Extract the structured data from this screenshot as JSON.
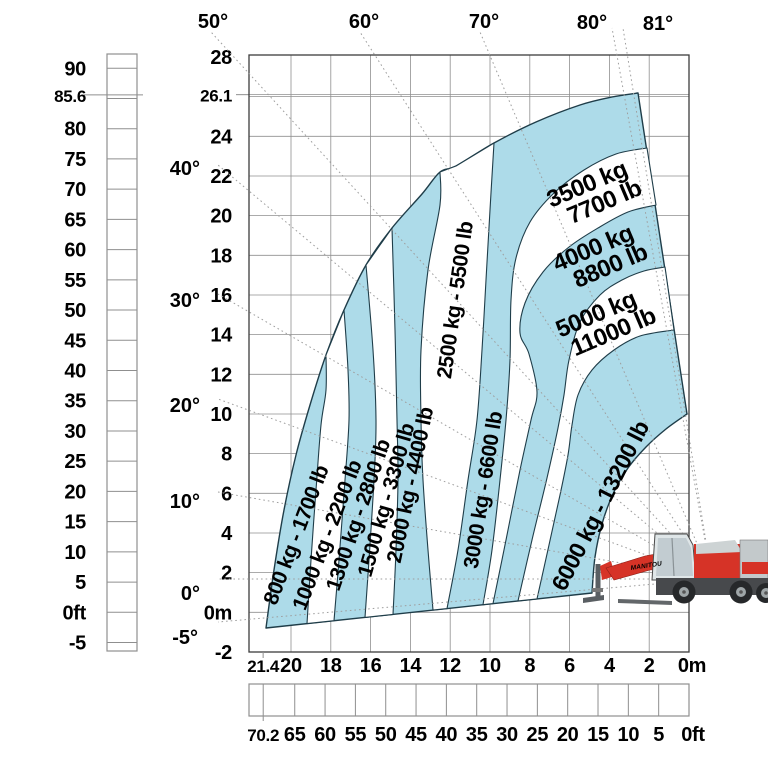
{
  "brand": "MANITOU",
  "colors": {
    "zone_blue": "#addbe9",
    "zone_white": "#ffffff",
    "outline": "#1f3d49",
    "grid": "#8f8f8f",
    "border": "#3c3c3c",
    "dotted_line": "#9e9e9e",
    "text": "#000000",
    "machine_red": "#d63327",
    "machine_dark": "#47494c",
    "machine_light": "#dfe6e8"
  },
  "chart_data": {
    "type": "area",
    "title": "",
    "description": "Telehandler load capacity envelope chart: lift height (m/ft) versus reach (m/ft) with boom angle lines and load capacity zones",
    "grid": true,
    "legend_position": "none",
    "x_axis": {
      "meters_ticks": [
        "21.4",
        "20",
        "18",
        "16",
        "14",
        "12",
        "10",
        "8",
        "6",
        "4",
        "2",
        "0m"
      ],
      "feet_ticks": [
        "70.2",
        "65",
        "60",
        "55",
        "50",
        "45",
        "40",
        "35",
        "30",
        "25",
        "20",
        "15",
        "10",
        "5",
        "0ft"
      ],
      "max_reach_m": 21.4,
      "max_reach_ft": 70.2,
      "range_m": [
        0,
        22.1
      ]
    },
    "y_axis": {
      "meters_ticks": [
        "28",
        "26.1",
        "24",
        "22",
        "20",
        "18",
        "16",
        "14",
        "12",
        "10",
        "8",
        "6",
        "4",
        "2",
        "0m",
        "-2"
      ],
      "feet_ticks": [
        "90",
        "85.6",
        "80",
        "75",
        "70",
        "65",
        "60",
        "55",
        "50",
        "45",
        "40",
        "35",
        "30",
        "25",
        "20",
        "15",
        "10",
        "5",
        "0ft",
        "-5"
      ],
      "max_height_m": 26.1,
      "max_height_ft": 85.6,
      "range_m": [
        -2,
        28.1
      ]
    },
    "boom_angles_top": [
      "50°",
      "60°",
      "70°",
      "80°",
      "81°"
    ],
    "boom_angles_left": [
      "40°",
      "30°",
      "20°",
      "10°",
      "0°",
      "-5°"
    ],
    "zones": [
      {
        "kg": 800,
        "lb": 1700,
        "label_lines": [
          "800 kg - 1700 lb"
        ],
        "fill": "blue"
      },
      {
        "kg": 1000,
        "lb": 2200,
        "label_lines": [
          "1000 kg - 2200 lb"
        ],
        "fill": "white"
      },
      {
        "kg": 1300,
        "lb": 2800,
        "label_lines": [
          "1300 kg - 2800 lb"
        ],
        "fill": "blue"
      },
      {
        "kg": 1500,
        "lb": 3300,
        "label_lines": [
          "1500 kg - 3300 lb"
        ],
        "fill": "white"
      },
      {
        "kg": 2000,
        "lb": 4400,
        "label_lines": [
          "2000 kg - 4400 lb"
        ],
        "fill": "blue"
      },
      {
        "kg": 2500,
        "lb": 5500,
        "label_lines": [
          "2500 kg - 5500 lb"
        ],
        "fill": "white"
      },
      {
        "kg": 3000,
        "lb": 6600,
        "label_lines": [
          "3000 kg - 6600 lb"
        ],
        "fill": "blue"
      },
      {
        "kg": 3500,
        "lb": 7700,
        "label_lines": [
          "3500 kg",
          "7700 lb"
        ],
        "fill": "white"
      },
      {
        "kg": 4000,
        "lb": 8800,
        "label_lines": [
          "4000 kg",
          "8800 lb"
        ],
        "fill": "blue"
      },
      {
        "kg": 5000,
        "lb": 11000,
        "label_lines": [
          "5000 kg",
          "11000 lb"
        ],
        "fill": "white"
      },
      {
        "kg": 6000,
        "lb": 13200,
        "label_lines": [
          "6000 kg - 13200 lb"
        ],
        "fill": "blue"
      }
    ]
  }
}
